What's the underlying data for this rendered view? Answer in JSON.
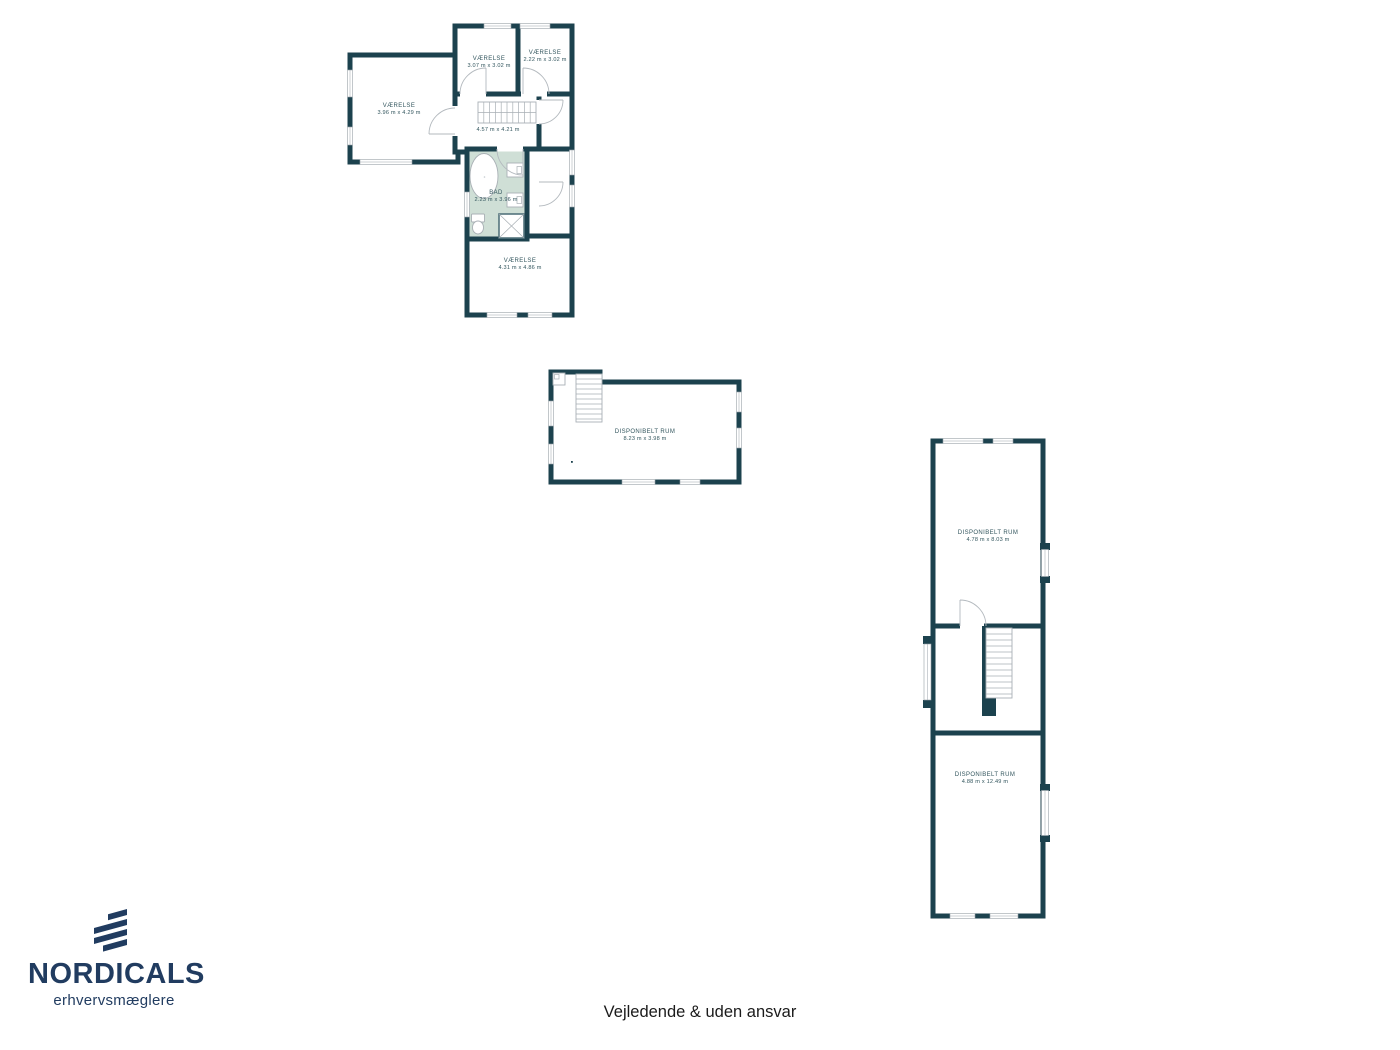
{
  "page": {
    "background": "#ffffff",
    "footer_disclaimer": "Vejledende & uden ansvar"
  },
  "branding": {
    "company": "NORDICALS",
    "tagline": "erhvervsmæglere"
  },
  "colors": {
    "wall": "#1c424e",
    "bathroom_fill": "#cfdfd6",
    "label_text": "#33565e",
    "logo_navy": "#213c60",
    "fixture_line": "#a9b0b5"
  },
  "floorplans": [
    {
      "rooms": [
        {
          "name": "VÆRELSE",
          "dimensions": "3.96 m x 4.29 m"
        },
        {
          "name": "VÆRELSE",
          "dimensions": "3.07 m x 3.02 m"
        },
        {
          "name": "VÆRELSE",
          "dimensions": "2.22 m x 3.02 m"
        },
        {
          "dimensions": "4.57 m x 4.21 m"
        },
        {
          "name": "BAD",
          "dimensions": "2.23 m x 3.96 m"
        },
        {
          "name": "VÆRELSE",
          "dimensions": "4.31 m x 4.86 m"
        }
      ]
    },
    {
      "rooms": [
        {
          "name": "DISPONIBELT RUM",
          "dimensions": "8.23 m x 3.98 m"
        }
      ]
    },
    {
      "rooms": [
        {
          "name": "DISPONIBELT RUM",
          "dimensions": "4.78 m x 8.03 m"
        },
        {
          "name": "DISPONIBELT RUM",
          "dimensions": "4.88 m x 12.49 m"
        }
      ]
    }
  ]
}
